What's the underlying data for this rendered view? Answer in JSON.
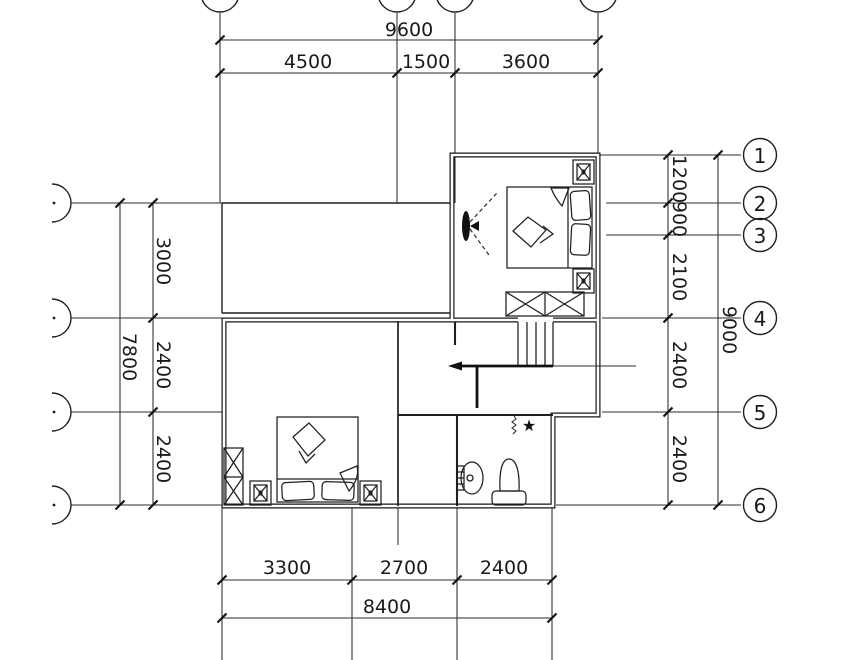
{
  "dims": {
    "top": {
      "total": "9600",
      "segments": [
        "4500",
        "1500",
        "3600"
      ]
    },
    "bottom": {
      "total": "8400",
      "segments": [
        "3300",
        "2700",
        "2400"
      ]
    },
    "left": {
      "total": "7800",
      "segments": [
        "3000",
        "2400",
        "2400"
      ]
    },
    "right": {
      "total": "9000",
      "segments": [
        "1200",
        "900",
        "2100",
        "2400",
        "2400"
      ]
    }
  },
  "grid": {
    "right_bubbles": [
      "1",
      "2",
      "3",
      "4",
      "5",
      "6"
    ]
  },
  "symbols": {
    "fixture_star": "★"
  }
}
